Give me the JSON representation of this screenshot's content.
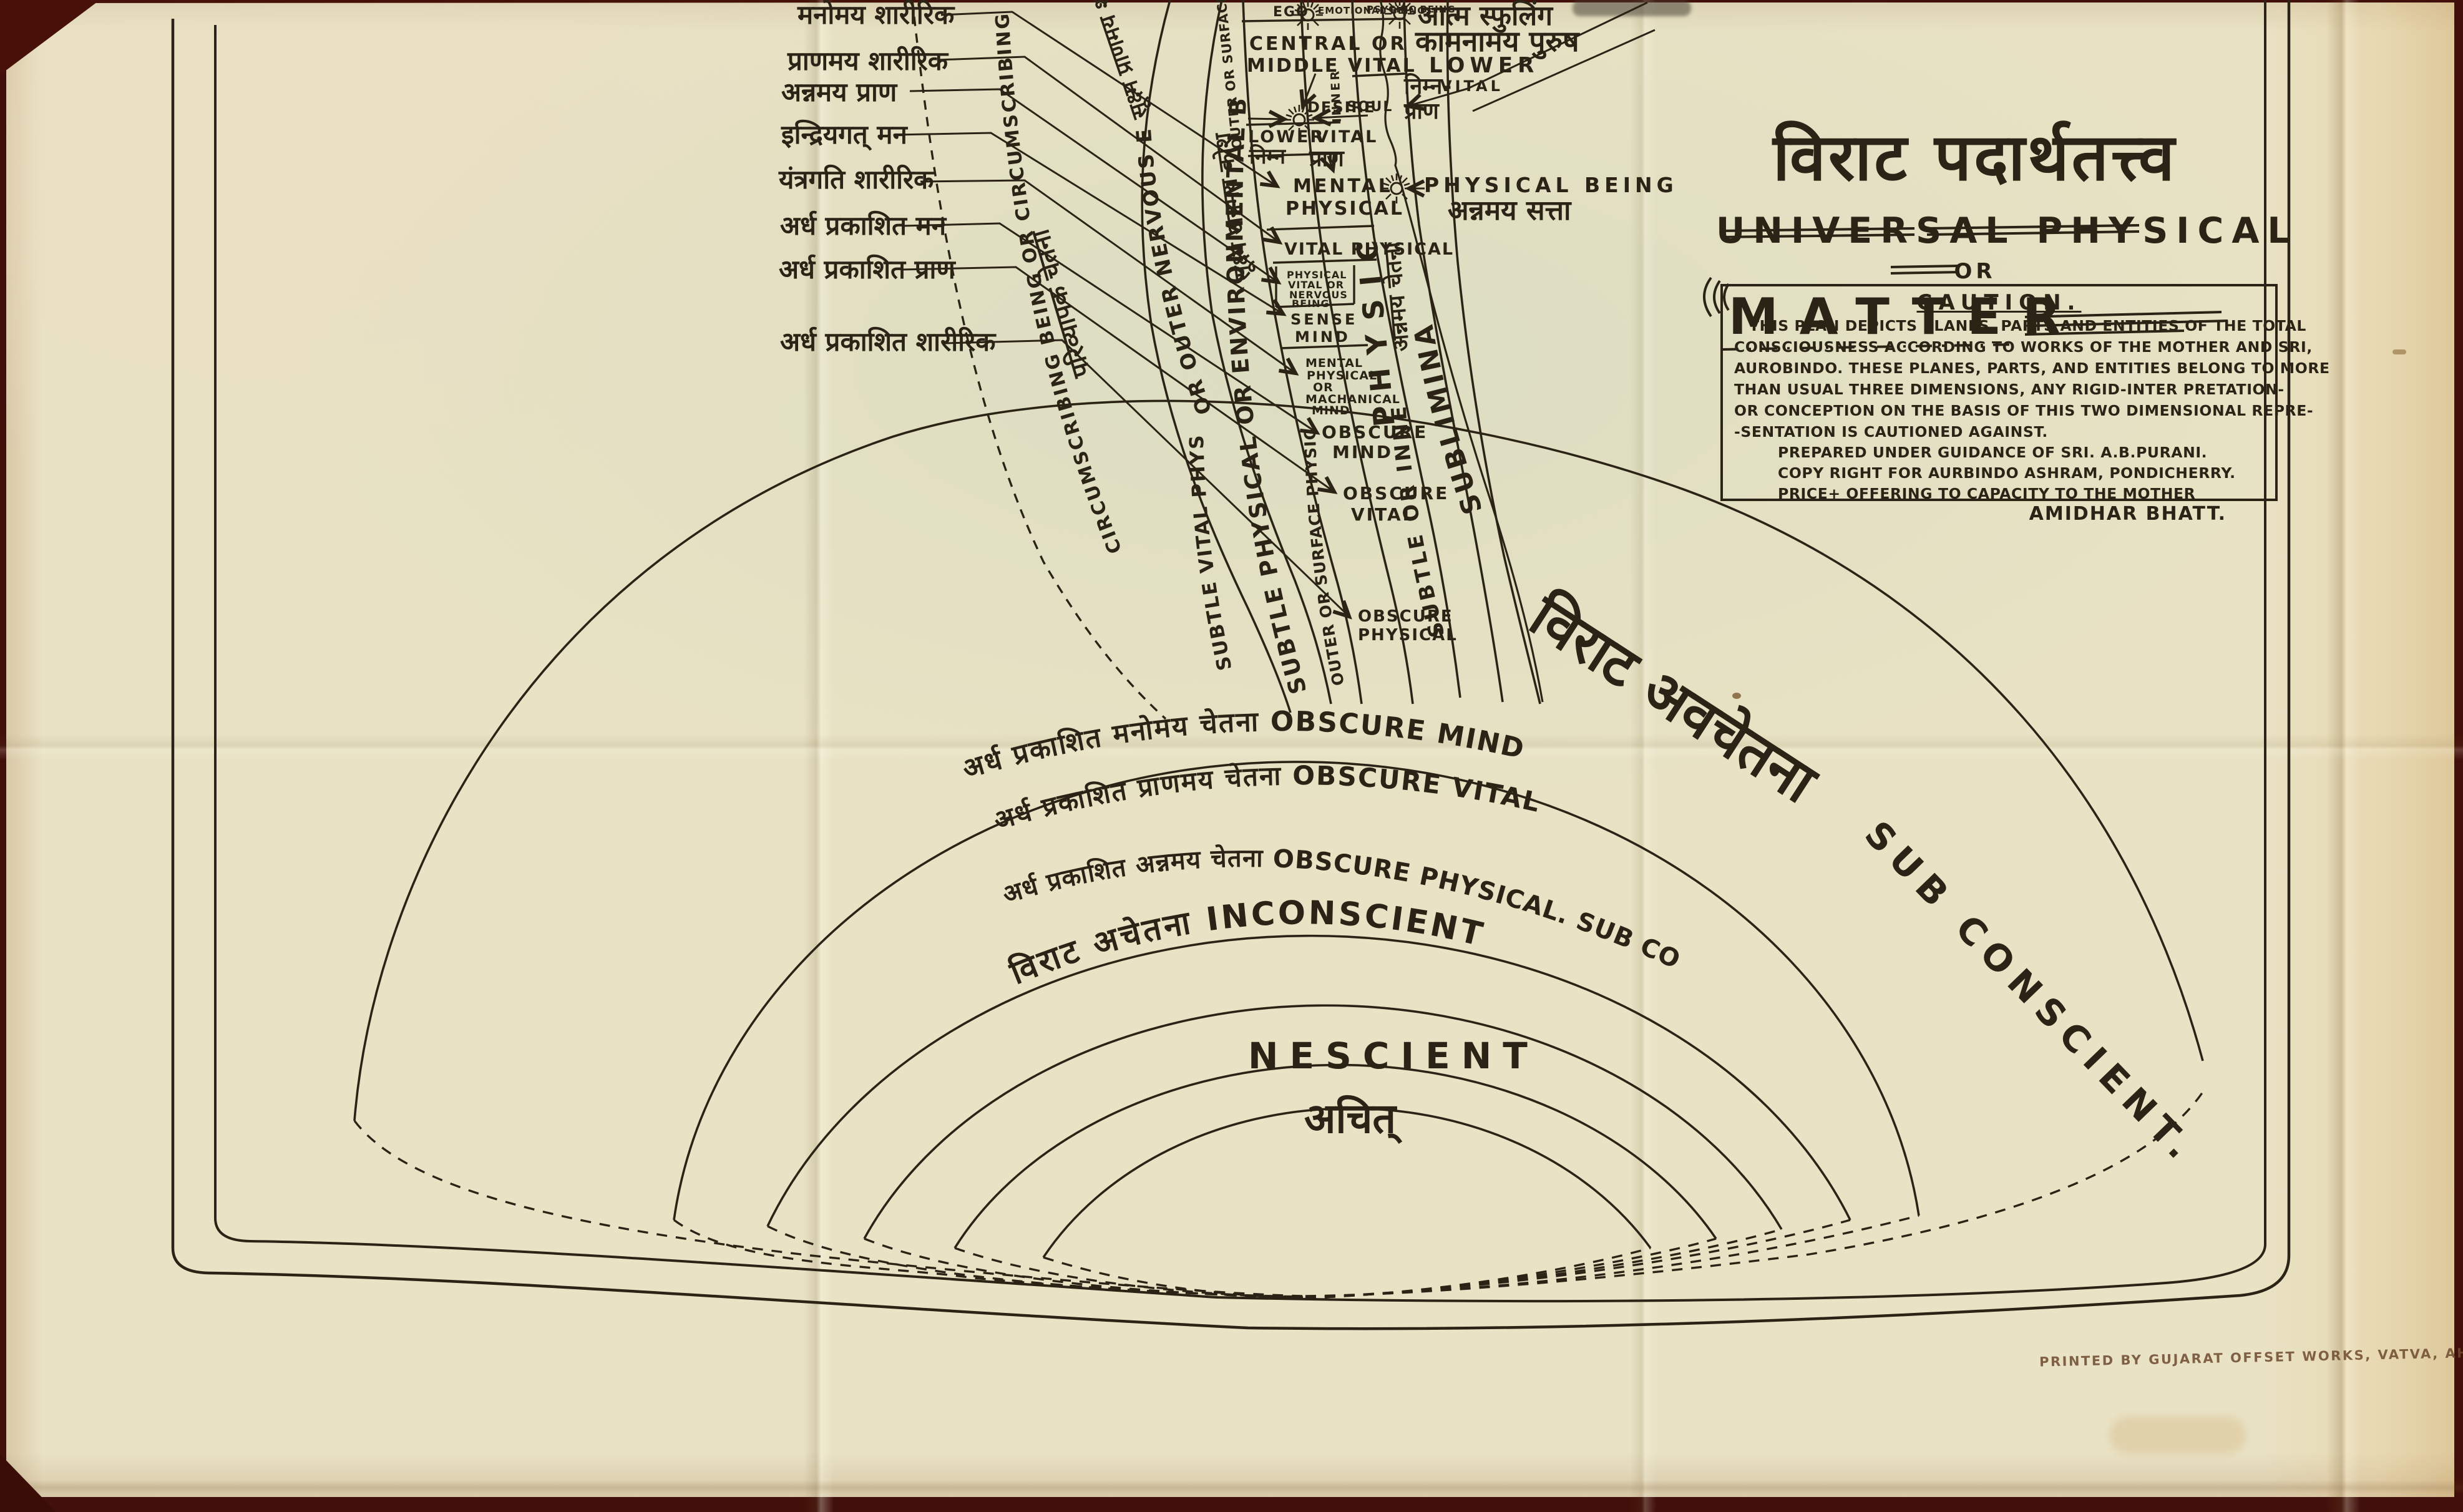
{
  "title": {
    "devanagari": "विराट पदार्थतत्त्व",
    "english_line": "UNIVERSAL PHYSICAL",
    "or_word": "OR",
    "matter_word": "MATTER"
  },
  "caution": {
    "heading": "CAUTION.",
    "body": [
      "THIS PLAN DEPICTS PLANES, PARTS AND ENTITIES OF THE TOTAL",
      "CONSCIOUSNESS ACCORDING TO WORKS OF THE MOTHER AND SRI,",
      "AUROBINDO. THESE PLANES, PARTS, AND ENTITIES BELONG TO MORE",
      "THAN USUAL THREE DIMENSIONS, ANY RIGID-INTER PRETATION-",
      "OR CONCEPTION ON THE BASIS OF THIS TWO DIMENSIONAL REPRE-",
      "-SENTATION IS CAUTIONED AGAINST."
    ],
    "credits": [
      "PREPARED UNDER GUIDANCE OF SRI. A.B.PURANI.",
      "COPY RIGHT FOR AURBINDO ASHRAM, PONDICHERRY.",
      "PRICE+ OFFERING TO CAPACITY TO THE MOTHER"
    ],
    "signature": "AMIDHAR BHATT."
  },
  "left_labels": [
    {
      "text": "मनोमय शारीरिक"
    },
    {
      "text": "प्राणमय शारीरिक"
    },
    {
      "text": "अन्नमय प्राण"
    },
    {
      "text": "इन्द्रियगत् मन"
    },
    {
      "text": "यंत्रगति शारीरिक"
    },
    {
      "text": "अर्ध प्रकाशित मन"
    },
    {
      "text": "अर्ध प्रकाशित प्राण"
    },
    {
      "text": "अर्ध प्रकाशित शारीरिक"
    }
  ],
  "top_row": {
    "ego": "EGO",
    "emotional": "EMOTIONAL BEING,",
    "psychic": "PSYCHIC BEING",
    "atma": "आत्म स्फुलिंग"
  },
  "right_cluster": {
    "kamanamaya": "कामनामय पुरुष",
    "lower": "LOWER",
    "vital": "VITAL",
    "nimna": "निम्न-",
    "prana": "प्राण"
  },
  "physical_being": {
    "english": "PHYSICAL BEING",
    "devanagari": "अन्नमय सत्ता"
  },
  "column": {
    "central_1": "CENTRAL OR",
    "central_2": "MIDDLE VITAL",
    "desire": "DESIRE",
    "soul": "SOUL",
    "inner": "INNER",
    "lower": "LOWER",
    "vital": "VITAL",
    "nimna": "निम्न",
    "prana": "प्राण",
    "mental_1": "MENTAL",
    "mental_2": "PHYSICAL",
    "vital_physical": "VITAL PHYSICAL",
    "pvnb_1": "PHYSICAL",
    "pvnb_2": "VITAL OR",
    "pvnb_3": "NERVOUS",
    "pvnb_4": "BEING",
    "sense_1": "SENSE",
    "sense_2": "MIND",
    "mach_1": "MENTAL",
    "mach_2": "PHYSICAL",
    "mach_3": "OR",
    "mach_4": "MACHANICAL",
    "mach_5": "MIND",
    "obscure_mind_1": "OBSCURE",
    "obscure_mind_2": "MIND",
    "obscure_vital_1": "OBSCURE",
    "obscure_vital_2": "VITAL",
    "obscure_physical_1": "OBSCURE",
    "obscure_physical_2": "PHYSICAL"
  },
  "bands": {
    "circumscribing": "CIRCUMSCRIBING BEING OR CIRCUMSCRIBING CONSCIOUSNESS",
    "parivyapak": "परिव्यापक चेतना",
    "nervous_envelope": "OR OUTER NERVOUS ENVELOPE",
    "sukshma_prana": "सूक्ष्म प्राणमय शरीर",
    "sukshma_anna": "सूक्ष्म अन्नमय कोश",
    "environmental": "SUBTLE PHYSICAL OR ENVIRONMENTAL BEING",
    "subtle_vital_physical": "SUBTLE VITAL PHYSICAL",
    "outer_surface_physical": "OUTER OR SURFACE PHYSICAL",
    "outer_surface_vital": "OUTER OR SURFACE VITAL",
    "physical_vertical": "PHYSICAL",
    "annamaya_chetana": "अन्नमय चेतना",
    "subtle_inner": "SUBTLE OR INNER",
    "subliminal": "SUBLIMINAL"
  },
  "rings": {
    "obscure_mind": "अर्ध प्रकाशित मनोमय चेतना OBSCURE  MIND",
    "obscure_vital": "अर्ध प्रकाशित प्राणमय चेतना   OBSCURE  VITAL",
    "obscure_physical": "अर्ध प्रकाशित अन्नमय चेतना OBSCURE PHYSICAL. SUB CONSCIENT अव चेतना",
    "inconscient": "विराट अचेतना  INCONSCIENT",
    "nescient_en": "NESCIENT",
    "nescient_dev": "अचित्",
    "subconscient_dev": "विराट अवचेतना",
    "subconscient_en": "SUB CONSCIENT."
  },
  "footer": {
    "printer_line": "PRINTED BY GUJARAT OFFSET WORKS, VATVA, AHMEDABAD"
  }
}
